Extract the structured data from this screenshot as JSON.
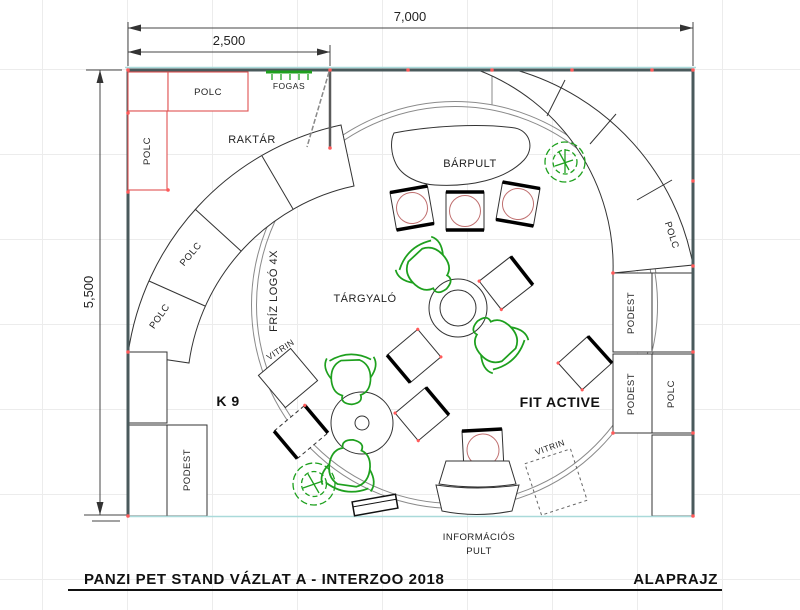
{
  "drawing": {
    "title": "PANZI PET STAND VÁZLAT A - INTERZOO 2018",
    "sheet_name": "ALAPRAJZ"
  },
  "dimensions": {
    "total_width": "7,000",
    "partial_width": "2,500",
    "total_height": "5,500"
  },
  "labels": {
    "polc": "POLC",
    "fogas": "FOGAS",
    "raktar": "RAKTÁR",
    "barpult": "BÁRPULT",
    "friz_logo": "FRÍZ LOGÓ 4X",
    "targyalo": "TÁRGYALÓ",
    "vitrin": "VITRIN",
    "k9": "K 9",
    "fit_active": "FIT ACTIVE",
    "podest": "PODEST",
    "info_line1": "INFORMÁCIÓS",
    "info_line2": "PULT"
  },
  "colors": {
    "wall": "#4a5a5c",
    "shelf_red": "#e05252",
    "plant_green": "#1ea01e",
    "floor_cyan": "#aadada",
    "dimension": "#444444"
  }
}
